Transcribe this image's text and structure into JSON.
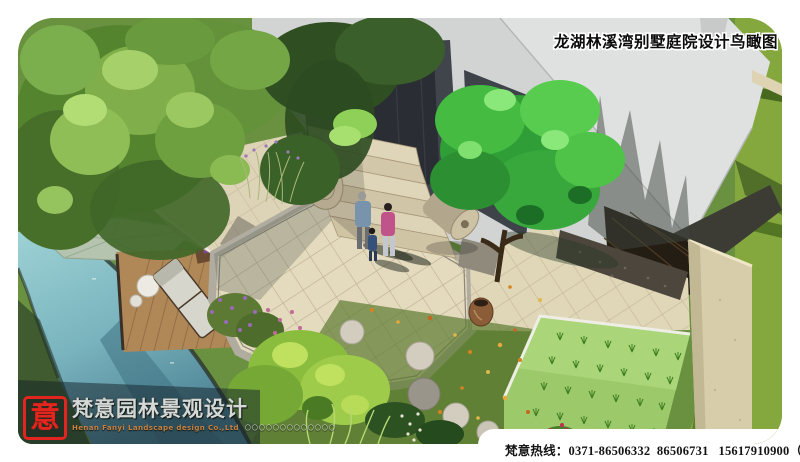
{
  "title": {
    "text": "龙湖林溪湾别墅庭院设计鸟瞰图"
  },
  "logo": {
    "seal_character": "意",
    "company_name_cn": "梵意园林景观设计",
    "company_name_en": "Henan Fanyi Landscape design Co.,Ltd",
    "decorative_dots": "〇〇〇〇〇〇〇〇〇〇〇〇〇"
  },
  "footer": {
    "hotline": "梵意热线：0371-86506332  86506731   15617910900（孙）"
  },
  "palette": {
    "page_bg": "#ffffff",
    "roof_light": "#d2d4d3",
    "roof_facet": "#dfe1e0",
    "building_shadow": "#3e434a",
    "door_dark": "#2a2e34",
    "lawn": "#6a9140",
    "lawn_right": "#85a83e",
    "water": "#8fc9ce",
    "water_deep": "#4e8496",
    "paving": "#e4dabd",
    "deck_wood": "#b08858",
    "wall_beige": "#d8cdaa",
    "bed_green": "#9cc96a",
    "tree_bright": "#49c148",
    "seal_red": "#e2251f",
    "title_text": "#0c0c0c",
    "hotline_text": "#141414"
  }
}
